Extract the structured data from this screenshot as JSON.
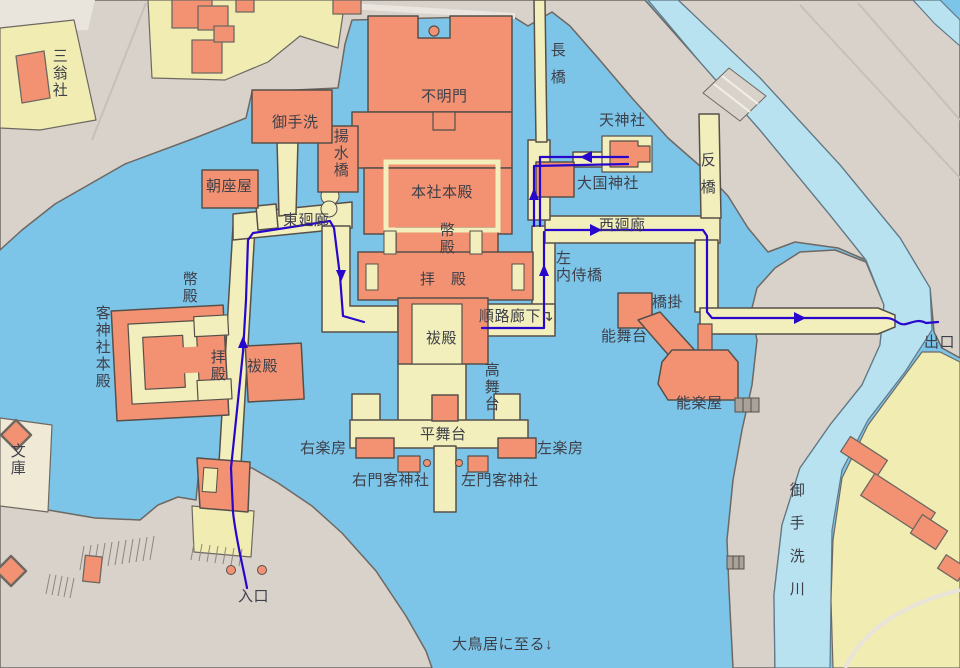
{
  "map": {
    "description": "Shrine precinct map with visitor route",
    "colors": {
      "water": "#7cc4e8",
      "river": "#b8e2f0",
      "land": "#d8d2ca",
      "parcel": "#f0ecb2",
      "corridor": "#f3efbc",
      "building": "#f29272",
      "outline": "#56504a",
      "route": "#2807cc",
      "text": "#3e4049"
    },
    "route": {
      "start_label": "入口",
      "end_label": "出口",
      "color": "#2807cc"
    },
    "labels": [
      {
        "id": "sannosha",
        "text": "三翁社",
        "v": true,
        "x": 50,
        "y": 48
      },
      {
        "id": "mitarashi",
        "text": "御手洗",
        "x": 272,
        "y": 115
      },
      {
        "id": "yosuibashi",
        "text": "揚水橋",
        "v": true,
        "x": 331,
        "y": 128
      },
      {
        "id": "fumeimon",
        "text": "不明門",
        "x": 421,
        "y": 89
      },
      {
        "id": "nagahashi",
        "text": "長橋",
        "v": true,
        "x": 548,
        "y": 42,
        "spacing": 12
      },
      {
        "id": "tenjinsha",
        "text": "天神社",
        "x": 599,
        "y": 113
      },
      {
        "id": "daikokujinja",
        "text": "大国神社",
        "x": 577,
        "y": 176
      },
      {
        "id": "sorihashi",
        "text": "反橋",
        "v": true,
        "x": 698,
        "y": 152,
        "spacing": 12
      },
      {
        "id": "asazaya",
        "text": "朝座屋",
        "x": 206,
        "y": 179
      },
      {
        "id": "higashikairo",
        "text": "東廻廊",
        "x": 283,
        "y": 213
      },
      {
        "id": "honsha-honden",
        "text": "本社本殿",
        "x": 411,
        "y": 185
      },
      {
        "id": "heiden-center",
        "text": "幣殿",
        "v": true,
        "x": 437,
        "y": 222
      },
      {
        "id": "nishikairo",
        "text": "西廻廊",
        "x": 599,
        "y": 218
      },
      {
        "id": "haiden-center",
        "text": "拝　殿",
        "x": 420,
        "y": 272
      },
      {
        "id": "hidari-naishibashi",
        "text": "左\n内侍橋",
        "x": 556,
        "y": 251
      },
      {
        "id": "heiden-left",
        "text": "幣殿",
        "v": true,
        "x": 180,
        "y": 271
      },
      {
        "id": "kyakujinja-honden",
        "text": "客神社本殿",
        "v": true,
        "x": 93,
        "y": 305
      },
      {
        "id": "haiden-left",
        "text": "拝殿",
        "v": true,
        "x": 208,
        "y": 349
      },
      {
        "id": "haraeden-left",
        "text": "祓殿",
        "x": 247,
        "y": 359
      },
      {
        "id": "haraeden-center",
        "text": "祓殿",
        "x": 426,
        "y": 331
      },
      {
        "id": "junro-roka",
        "text": "順路廊下↴",
        "x": 479,
        "y": 309
      },
      {
        "id": "hashigakari",
        "text": "橋掛",
        "x": 652,
        "y": 295
      },
      {
        "id": "nobutai",
        "text": "能舞台",
        "x": 601,
        "y": 329
      },
      {
        "id": "nogakuya",
        "text": "能楽屋",
        "x": 676,
        "y": 396
      },
      {
        "id": "deguchi",
        "text": "出口",
        "x": 924,
        "y": 335
      },
      {
        "id": "takabutai",
        "text": "高舞台",
        "v": true,
        "x": 482,
        "y": 362
      },
      {
        "id": "bunko",
        "text": "文庫",
        "v": true,
        "x": 8,
        "y": 443
      },
      {
        "id": "migi-gakubo",
        "text": "右楽房",
        "x": 300,
        "y": 441
      },
      {
        "id": "hirabutai",
        "text": "平舞台",
        "x": 420,
        "y": 427
      },
      {
        "id": "hidari-gakubo",
        "text": "左楽房",
        "x": 537,
        "y": 441
      },
      {
        "id": "migimon-kyakujinja",
        "text": "右門客神社",
        "x": 352,
        "y": 473
      },
      {
        "id": "hidarimon-kyakujinja",
        "text": "左門客神社",
        "x": 461,
        "y": 473
      },
      {
        "id": "mitarashigawa",
        "text": "御手洗川",
        "v": true,
        "x": 787,
        "y": 482,
        "spacing": 18
      },
      {
        "id": "iriguchi",
        "text": "入口",
        "x": 238,
        "y": 589
      },
      {
        "id": "otorii",
        "text": "大鳥居に至る↓",
        "x": 452,
        "y": 637
      }
    ]
  }
}
